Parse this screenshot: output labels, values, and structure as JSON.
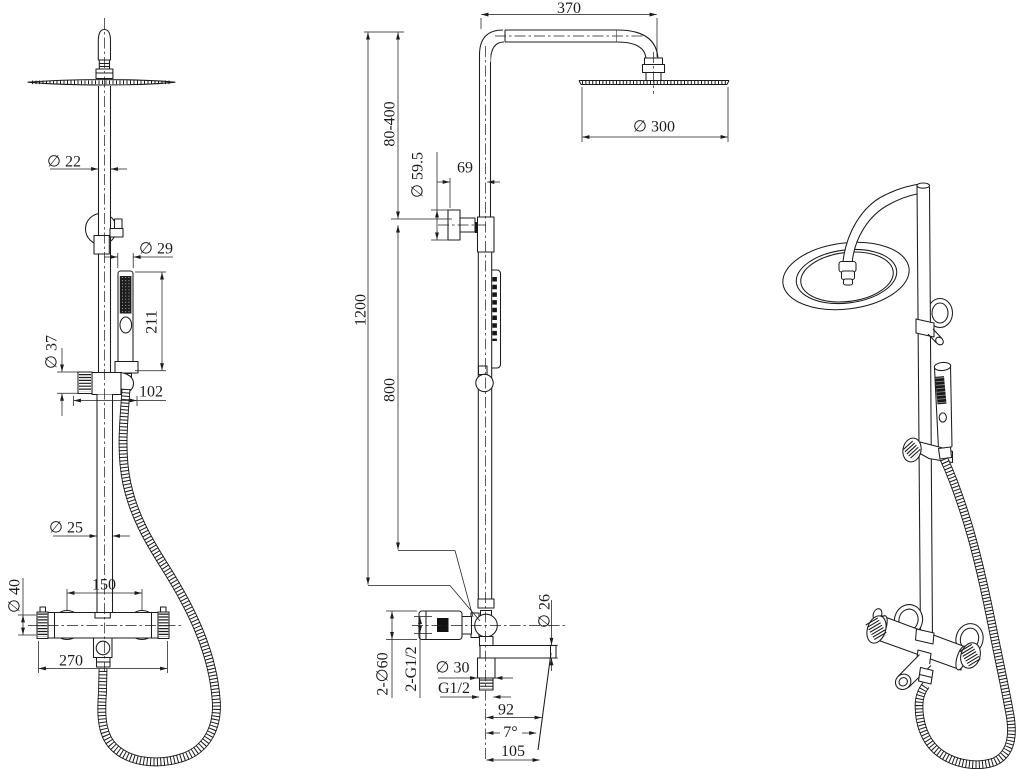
{
  "drawing": {
    "background_color": "#ffffff",
    "line_color": "#1c1c1c",
    "views": {
      "front": {
        "dims": {
          "pipe_dia": "∅ 22",
          "hand_dia": "∅ 29",
          "hand_len": "211",
          "slider_dia": "∅ 37",
          "slider_off": "102",
          "riser_dia": "∅ 25",
          "body_dia": "∅ 40",
          "inlet_cc": "150",
          "overall_w": "270"
        }
      },
      "side": {
        "dims": {
          "arm_reach": "370",
          "adjust": "80-400",
          "flange_dia": "∅ 59.5",
          "wall_off": "69",
          "height_total": "1200",
          "height_lower": "800",
          "head_dia": "∅ 300",
          "spout_dia": "∅ 26",
          "escutcheon": "2-∅60",
          "inlets": "2-G1/2",
          "outlet_dia": "∅ 30",
          "outlet_thread": "G1/2",
          "spout_horiz": "92",
          "spout_angle": "7°",
          "spout_reach": "105"
        }
      }
    }
  }
}
